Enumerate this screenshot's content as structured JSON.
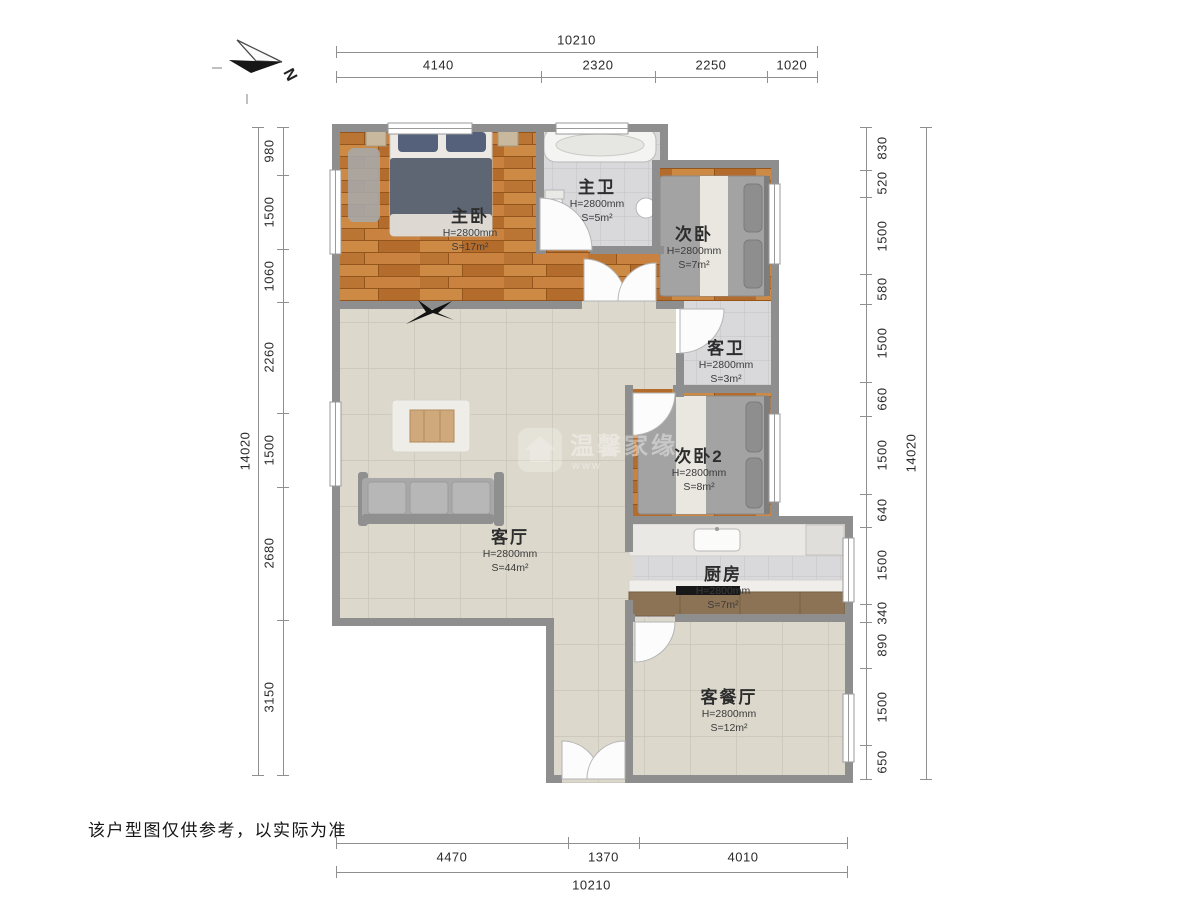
{
  "disclaimer": "该户型图仅供参考，以实际为准",
  "north": {
    "label": "N"
  },
  "watermark": {
    "line1": "温馨家缘",
    "line2": "www"
  },
  "rooms": [
    {
      "name": "主卧",
      "height": "H=2800mm",
      "area": "S=17m²"
    },
    {
      "name": "主卫",
      "height": "H=2800mm",
      "area": "S=5m²"
    },
    {
      "name": "次卧",
      "height": "H=2800mm",
      "area": "S=7m²"
    },
    {
      "name": "客卫",
      "height": "H=2800mm",
      "area": "S=3m²"
    },
    {
      "name": "次卧2",
      "height": "H=2800mm",
      "area": "S=8m²"
    },
    {
      "name": "客厅",
      "height": "H=2800mm",
      "area": "S=44m²"
    },
    {
      "name": "厨房",
      "height": "H=2800mm",
      "area": "S=7m²"
    },
    {
      "name": "客餐厅",
      "height": "H=2800mm",
      "area": "S=12m²"
    }
  ],
  "dimensions": {
    "top": {
      "total": "10210",
      "segments": [
        "4140",
        "2320",
        "2250",
        "1020"
      ]
    },
    "bottom": {
      "total": "10210",
      "segments": [
        "4470",
        "1370",
        "4010"
      ]
    },
    "left": {
      "total": "14020",
      "segments": [
        "980",
        "1500",
        "1060",
        "2260",
        "1500",
        "2680",
        "3150"
      ]
    },
    "right": {
      "total": "14020",
      "segments": [
        "830",
        "520",
        "1500",
        "580",
        "1500",
        "660",
        "1500",
        "640",
        "1500",
        "340",
        "890",
        "1500",
        "650"
      ]
    }
  },
  "colors": {
    "wall": "#8e8e8e",
    "wood": "#c0793a",
    "tile_beige": "#dcd8cc",
    "tile_gray": "#d9d9db",
    "accent_counter": "#8d7355"
  }
}
